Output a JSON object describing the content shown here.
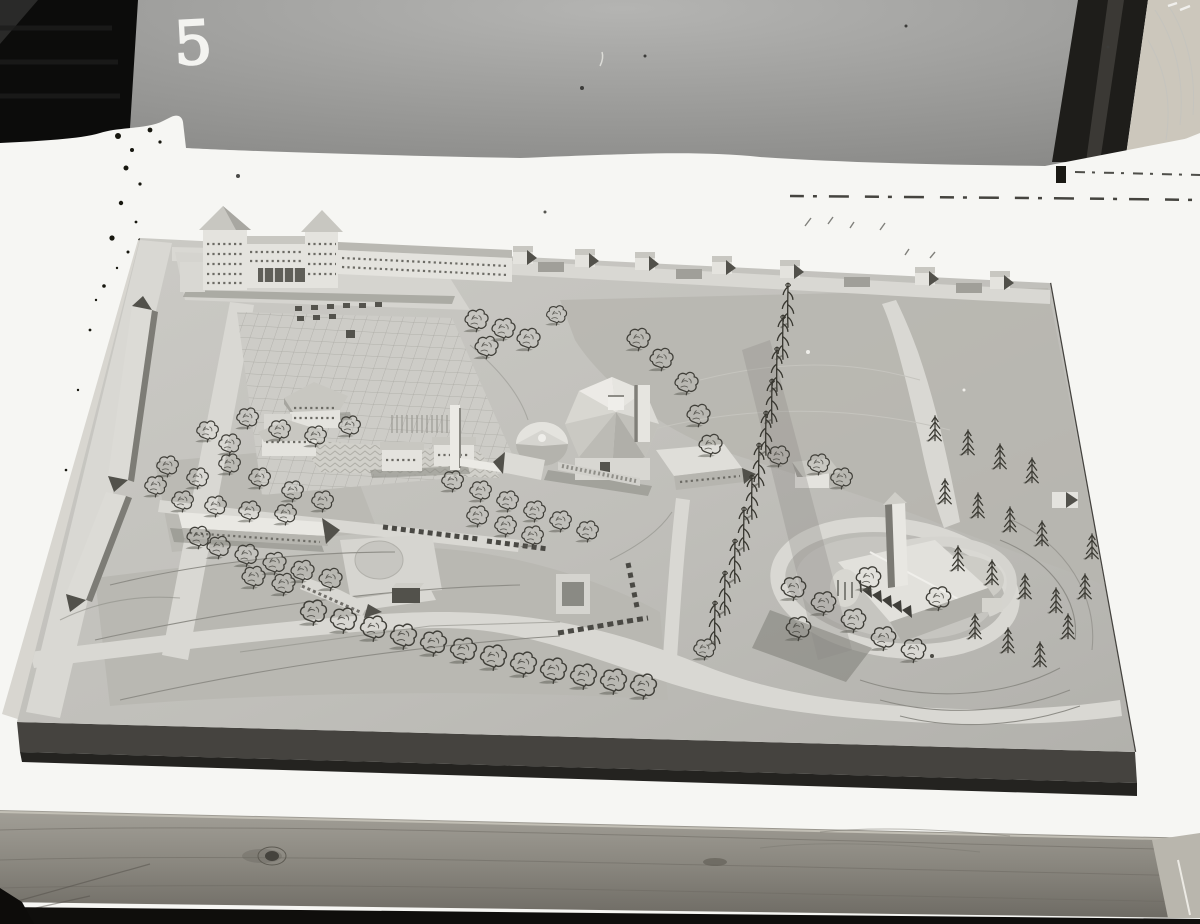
{
  "photo": {
    "frame_number": "5"
  },
  "palette": {
    "backdrop_black": "#0d0d0d",
    "backdrop_gray": "#9a9a98",
    "band_dark": "#1f1e1b",
    "wood_corner": "#ccc7bc",
    "paper_white": "#f6f6f3",
    "model_board": "#c2c1bc",
    "board_side": "#45433f",
    "road_light": "#d9d8d3",
    "tree_ink": "#403f39",
    "wood_table": "#8e8b83"
  }
}
